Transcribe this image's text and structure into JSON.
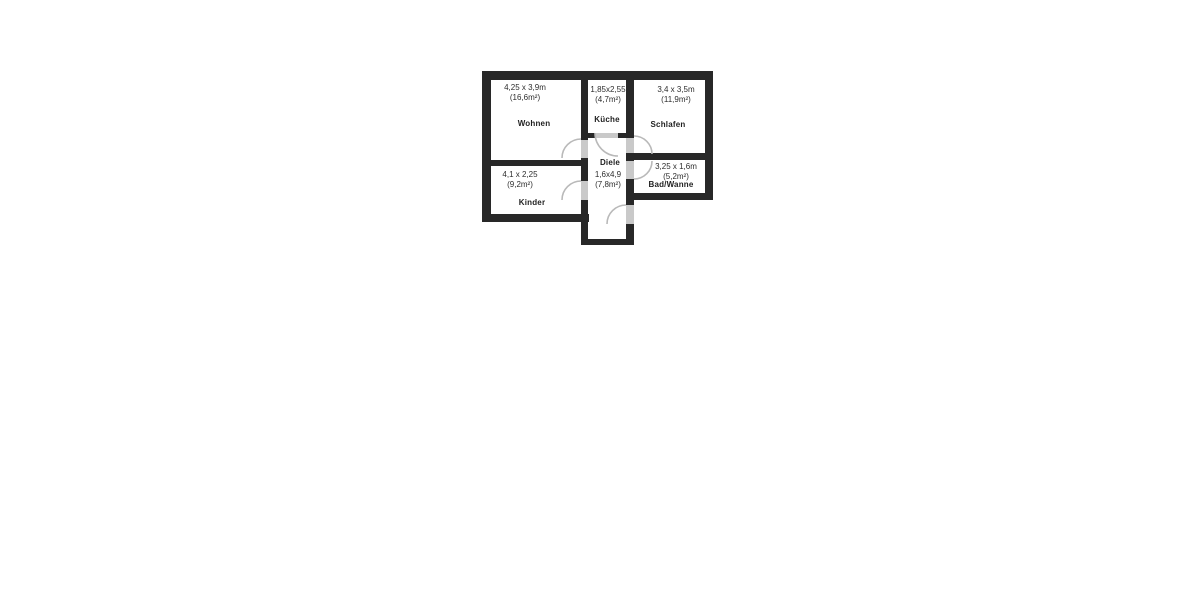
{
  "floorplan": {
    "kind": "apartment-floor-plan",
    "colors": {
      "wall": "#282828",
      "door_arc": "#b9b9b9",
      "door_leaf": "#c9c9c9",
      "background": "#ffffff"
    },
    "rooms": [
      {
        "id": "wohnen",
        "name": "Wohnen",
        "dimensions": "4,25 x 3,9m",
        "area": "(16,6m²)"
      },
      {
        "id": "kueche",
        "name": "Küche",
        "dimensions": "1,85x2,55",
        "area": "(4,7m²)"
      },
      {
        "id": "schlafen",
        "name": "Schlafen",
        "dimensions": "3,4 x 3,5m",
        "area": "(11,9m²)"
      },
      {
        "id": "kinder",
        "name": "Kinder",
        "dimensions": "4,1 x 2,25",
        "area": "(9,2m²)"
      },
      {
        "id": "diele",
        "name": "Diele",
        "dimensions": "1,6x4,9",
        "area": "(7,8m²)"
      },
      {
        "id": "bad",
        "name": "Bad/Wanne",
        "dimensions": "3,25 x 1,6m",
        "area": "(5,2m²)"
      }
    ]
  }
}
